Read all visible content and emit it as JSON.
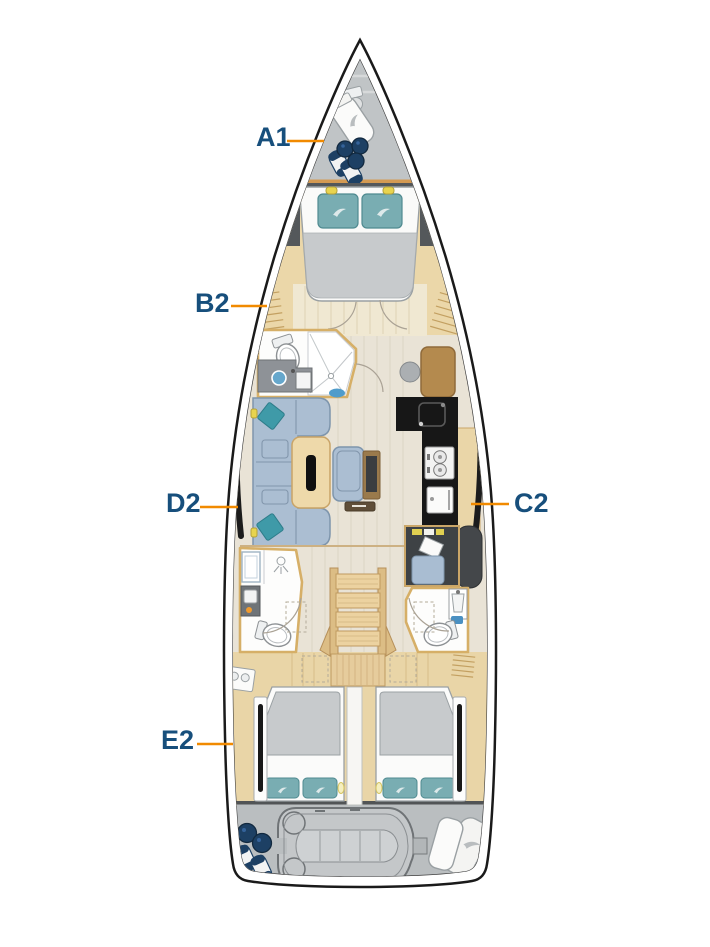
{
  "plan": {
    "labels": {
      "a1": "A1",
      "b2": "B2",
      "c2": "C2",
      "d2": "D2",
      "e2": "E2"
    },
    "colors": {
      "label_text": "#174f7c",
      "leader_line": "#f18a00",
      "hull_line": "#1a1a1a",
      "bow_locker": "#c0c4c6",
      "wood_trim": "#ebd7a9",
      "salon_floor": "#e9e3d6",
      "aft_wood": "#e9d5a7",
      "mattress": "#c7cacc",
      "pillow_teal": "#79adb2",
      "upholstery_blue": "#abbed2",
      "galley_black": "#171717",
      "fender_navy": "#1d4064",
      "table_wood": "#eed9aa",
      "lazarette": "#babec0"
    }
  }
}
